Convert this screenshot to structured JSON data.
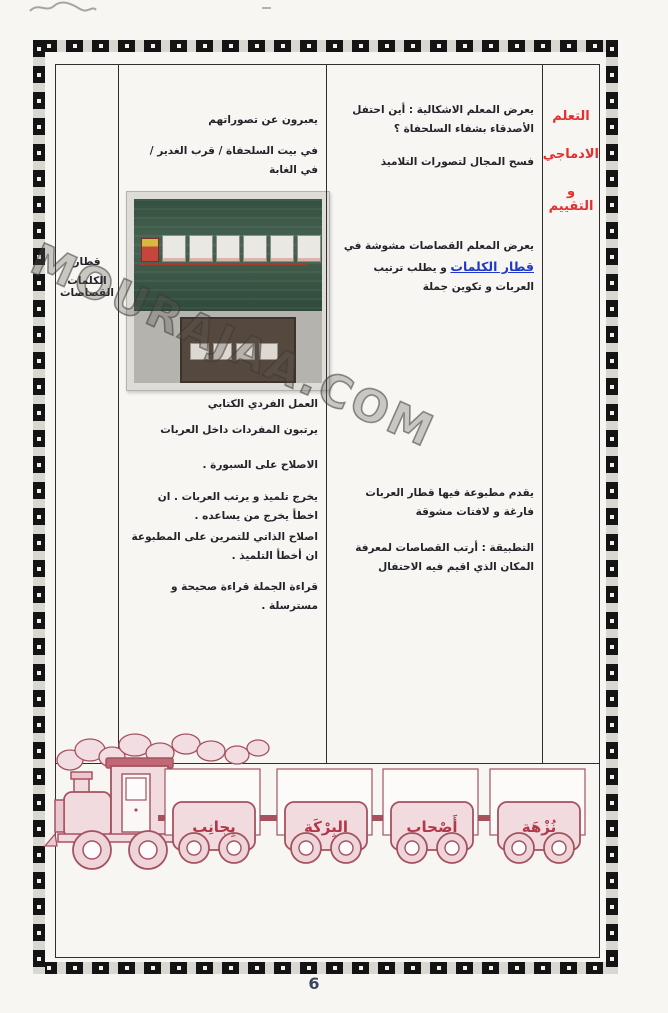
{
  "page": {
    "number": "6"
  },
  "watermark": {
    "text": "MOURAJAA.COM"
  },
  "columns": {
    "assessment": {
      "lines": [
        "التعلم",
        "الادماجي",
        "و التقييم"
      ]
    },
    "teacher": {
      "p1": "يعرض المعلم الاشكالية : أين احتفل الأصدقاء بشفاء السلحفاة ؟",
      "p2": "فسح المجال لتصورات التلاميذ",
      "p3_before": "يعرض المعلم القصاصات مشوشة في ",
      "p3_highlight": "قطار الكلمات",
      "p3_after": " و يطلب ترتيب العربات و تكوين جملة",
      "p4": "يقدم مطبوعة فيها قطار العربات فارغة و لافتات مشوقة",
      "p5": "التطبيقة : أرتب القصاصات لمعرفة المكان الذي اقيم فيه الاحتفال"
    },
    "pupil": {
      "p1": "يعبرون عن تصوراتهم",
      "p2": "في بيت السلحفاة / قرب الغدير / في الغابة",
      "p3": "العمل الفردي الكتابي",
      "p4": "يرتبون المفردات داخل العربات",
      "p5": "الاصلاح على السبورة .",
      "p6": "يخرج تلميذ و يرتب العربات . ان اخطأ يخرج من يساعده .",
      "p7": "اصلاح الذاتي للتمرين على المطبوعة ان أخطأ التلميذ .",
      "p8": "قراءة الجملة قراءة صحيحة و مسترسلة ."
    },
    "materials": {
      "line1": "قطار الكلمات",
      "line2": "القصاصات"
    }
  },
  "train": {
    "wagon_words_left_to_right": [
      "بِجانِب",
      "البِرْكَة",
      "أَصْحاب",
      "نُزْهَة"
    ]
  },
  "colors": {
    "assessment_red": "#e42f2f",
    "highlight_blue": "#2038c8",
    "train_outline": "#a5525e",
    "train_fill": "#f1dbdf",
    "chalkboard_green": "#476351"
  }
}
